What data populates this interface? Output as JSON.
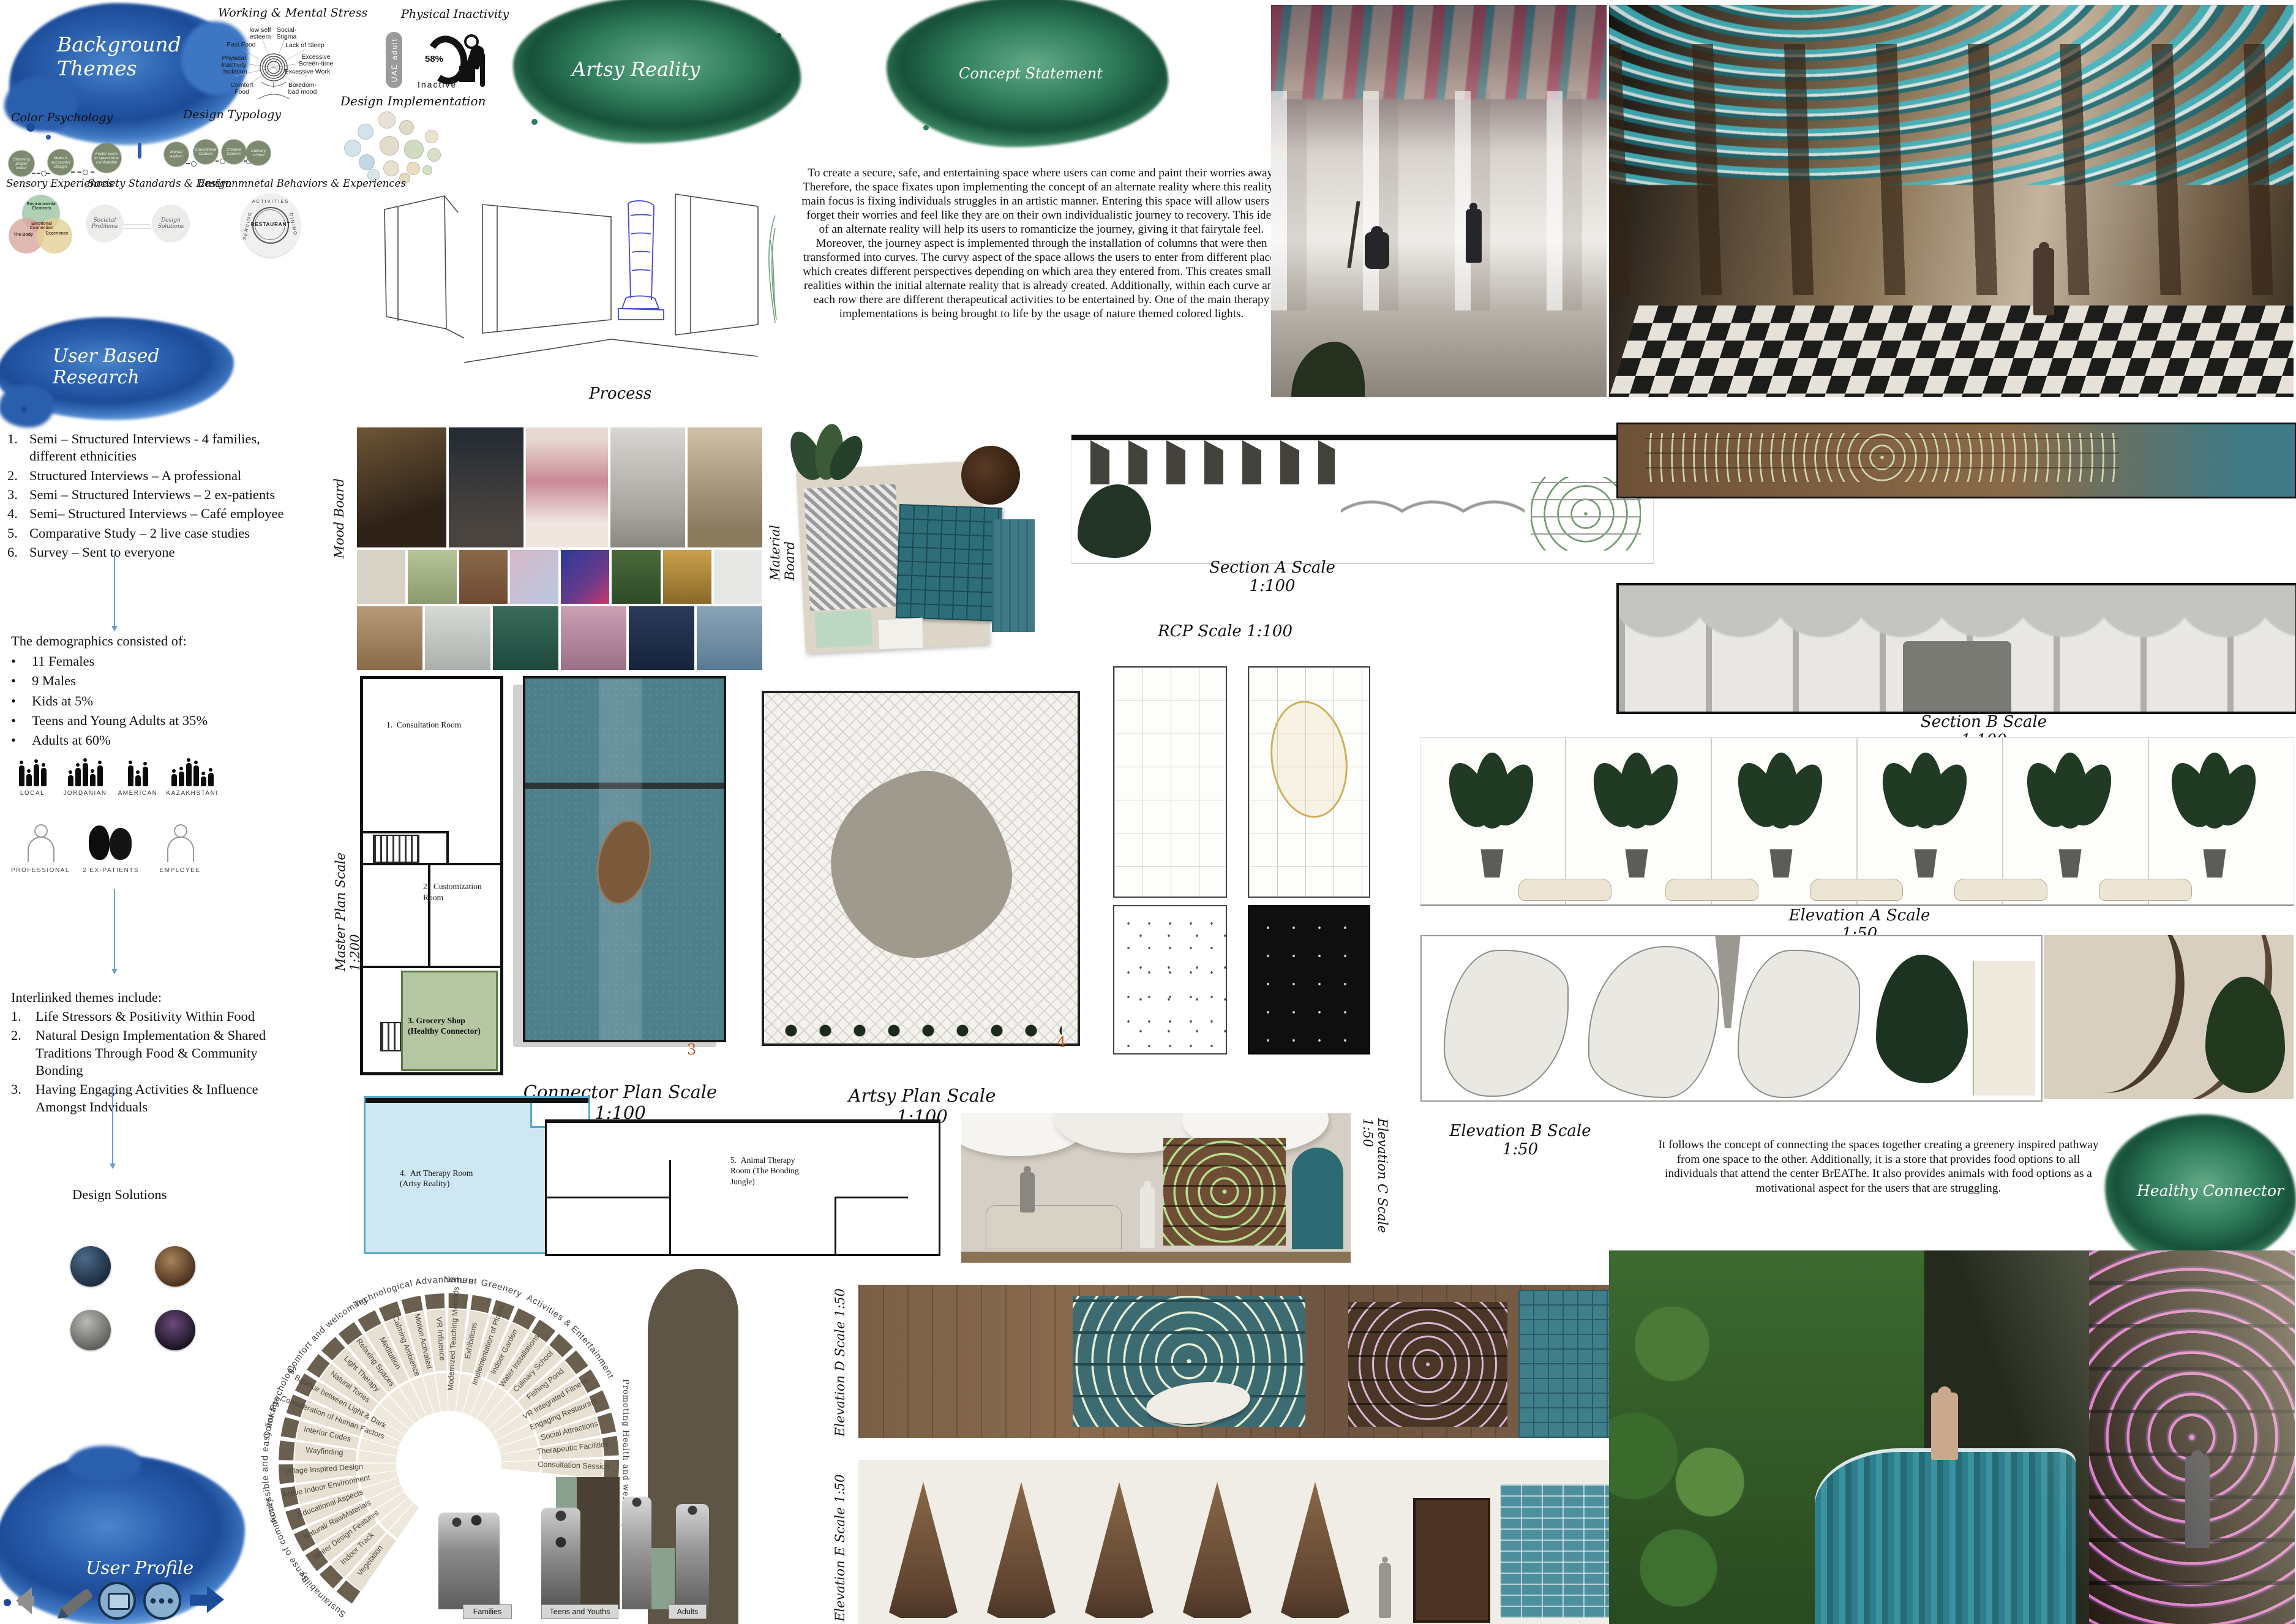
{
  "blobs": {
    "background_themes": "Background Themes",
    "user_based_research": "User Based Research",
    "artsy_reality": "Artsy Reality",
    "concept_statement": "Concept Statement",
    "healthy_connector": "Healthy Connector",
    "user_profile": "User Profile"
  },
  "mental_stress": {
    "title": "Working & Mental Stress",
    "labels": [
      "low self\nesteem",
      "Social-\nStigma",
      "Fast Food",
      "Lack of Sleep",
      "Physical\nInactivity",
      "Excessive\nScreen-time",
      "Isolation",
      "Excessive Work",
      "Comfort\nFood",
      "Boredom-\nbad mood"
    ]
  },
  "physical_inactivity": {
    "title": "Physical Inactivity",
    "pill": "UAE adult",
    "percent": "58%",
    "caption": "Inactive"
  },
  "design_implementation": {
    "title": "Design Implementation"
  },
  "color_psychology": {
    "title": "Color Psychology",
    "steps": [
      "Choosing\nproper\ncolour",
      "Make A\nsuccessful\nDesign",
      "Foster users\nto spend time\ncomfortable"
    ]
  },
  "design_typology": {
    "title": "Design Typology",
    "steps": [
      "Mental\nasylum",
      "Educational\nCenters",
      "Creative\nCenters",
      "Culinary\nschool"
    ]
  },
  "sensory": {
    "title": "Sensory Experiences",
    "venn": {
      "top": "Environmental\nElements",
      "center": "Emotional\nConnection",
      "left": "The Body",
      "right": "Experience"
    }
  },
  "society": {
    "title": "Society Standards & Design",
    "left": "Societal\nProblems",
    "right": "Design\nSolutions"
  },
  "environmental": {
    "title": "Environmnetal Behaviors & Experiences",
    "ring_top": "ACTIVITIES",
    "ring_left": "SERVING",
    "ring_right": "DINING",
    "center": "RESTAURANT"
  },
  "concept": {
    "paragraph": "To create a secure, safe, and entertaining space where users can come and paint their worries away. Therefore, the space fixates upon implementing the concept of an alternate reality where this reality's main focus is fixing individuals struggles in an artistic manner. Entering this space will allow users to forget their worries and feel like they are on their own individualistic journey to recovery. This idea of an alternate reality will help its users to romanticize the journey, giving it that fairytale feel. Moreover, the journey aspect is implemented through the installation of columns that were then transformed into curves. The curvy aspect of the space allows the users to enter from different places which creates different perspectives depending on which area they entered from. This creates smaller realities within the initial alternate reality that is already created. Additionally, within each curve and each row there are different therapeutical activities to be entertained by. One of the main therapy implementations is being brought to life by the usage of nature themed colored lights."
  },
  "process_label": "Process",
  "research": {
    "items": [
      "Semi – Structured Interviews  - 4 families, different ethnicities",
      "Structured Interviews – A professional",
      "Semi – Structured Interviews – 2 ex-patients",
      "Semi– Structured Interviews – Café employee",
      "Comparative Study – 2 live case studies",
      "Survey – Sent to everyone"
    ],
    "demographics_title": "The demographics consisted of:",
    "demographics": [
      "11 Females",
      "9 Males",
      "Kids at 5%",
      "Teens and Young Adults at 35%",
      "Adults at 60%"
    ],
    "ethnicities": [
      "LOCAL",
      "JORDANIAN",
      "AMERICAN",
      "KAZAKHSTANI"
    ],
    "roles": [
      "PROFESSIONAL",
      "2 EX-PATIENTS",
      "EMPLOYEE"
    ],
    "interlinked_title": "Interlinked themes include:",
    "interlinked": [
      "Life Stressors & Positivity Within Food",
      "Natural Design Implementation & Shared Traditions Through Food & Community Bonding",
      "Having Engaging Activities & Influence Amongst Indviduals"
    ],
    "design_solutions": "Design Solutions"
  },
  "labels": {
    "mood_board": "Mood Board",
    "material_board": "Material Board",
    "section_a": "Section A  Scale 1:100",
    "rcp": "RCP Scale 1:100",
    "section_b": "Section B  Scale 1:100",
    "elevation_a": "Elevation A  Scale 1:50",
    "elevation_b": "Elevation B  Scale 1:50",
    "elevation_c": "Elevation C  Scale 1:50",
    "elevation_d": "Elevation D  Scale 1:50",
    "elevation_e": "Elevation E  Scale 1:50",
    "master_plan": "Master Plan Scale 1:200",
    "connector_plan": "Connector Plan Scale 1:100",
    "artsy_plan": "Artsy Plan Scale 1:100"
  },
  "rooms": [
    {
      "num": "1.",
      "name": "Consultation Room"
    },
    {
      "num": "2.",
      "name": "Customization Room"
    },
    {
      "num": "3.",
      "name": "Grocery Shop\n(Healthy Connector)"
    },
    {
      "num": "4.",
      "name": "Art Therapy Room\n(Artsy Reality)"
    },
    {
      "num": "5.",
      "name": "Animal Therapy\nRoom (The Bonding\nJungle)"
    }
  ],
  "page_numbers": {
    "connector": "3",
    "artsy": "4"
  },
  "healthy_connector_text": "It follows the concept of connecting the spaces together creating a greenery inspired pathway from one space to the other. Additionally, it is a store that provides food options to all individuals that attend the center BrEAThe. It also provides animals with food options as a motivational aspect for the users that are struggling.",
  "sunburst": {
    "categories": [
      "Sustainability",
      "Sense of community",
      "Accessible and easy linkage",
      "Color Psychology",
      "Comfort and welcoming",
      "Technological Advancement",
      "Nature- Greenery",
      "Activities & Entertainment"
    ],
    "vertical_category": "Promoting Health and wellbeing",
    "spokes": [
      "Vegetation",
      "Indoor Track",
      "Water Design Features",
      "Natural/ RawMaterials",
      "Educational Aspects",
      "Active Indoor Environment",
      "Village Inspired Design",
      "Wayfinding",
      "Interior Codes",
      "Consideration of Human Factors",
      "Balance between Light & Dark",
      "Natural Tones",
      "Light Therapy",
      "Relaxing Spaces",
      "Meditation",
      "Calming Ambience",
      "Motion Activated",
      "VR Influence",
      "Modernized Teaching Methods",
      "Exhibitions",
      "Implementation of Plants",
      "Indoor Garden",
      "Water Installations",
      "Culinary School",
      "Fishing Pond",
      "VR Integrated Fitness",
      "Engaging Restaurant",
      "Social Attractions",
      "Therapeutic Facilities",
      "Consultation Session"
    ],
    "bars": [
      "Families",
      "Teens and Youths",
      "Adults"
    ]
  },
  "colors": {
    "accent_blue": "#2a5fae",
    "accent_green": "#2f7d5c",
    "teal_plan": "#4e7f8c",
    "room_green": "#b6c6a2",
    "room_blue": "#cfe7f2",
    "ring_dark": "#6b5f50"
  }
}
